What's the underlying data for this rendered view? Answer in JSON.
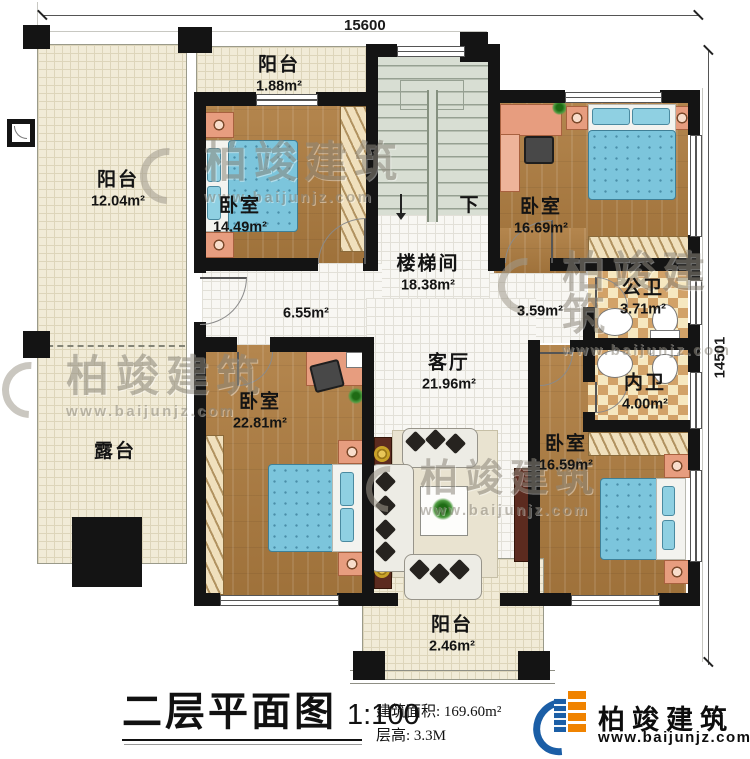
{
  "dimensions": {
    "top_width": "15600",
    "right_height": "14501"
  },
  "rooms": {
    "balcony_left": {
      "name": "阳台",
      "area": "12.04m²"
    },
    "terrace": {
      "name": "露台"
    },
    "balcony_top": {
      "name": "阳台",
      "area": "1.88m²"
    },
    "bedroom_top_left": {
      "name": "卧室",
      "area": "14.49m²"
    },
    "stairwell": {
      "name": "楼梯间",
      "area": "18.38m²",
      "direction": "下"
    },
    "bedroom_top_right": {
      "name": "卧室",
      "area": "16.69m²"
    },
    "hallway": {
      "area": "6.55m²"
    },
    "corridor": {
      "area": "3.59m²"
    },
    "living_room": {
      "name": "客厅",
      "area": "21.96m²"
    },
    "public_bath": {
      "name": "公卫",
      "area": "3.71m²"
    },
    "inner_bath": {
      "name": "内卫",
      "area": "4.00m²"
    },
    "bedroom_bottom_left": {
      "name": "卧室",
      "area": "22.81m²"
    },
    "bedroom_bottom_right": {
      "name": "卧室",
      "area": "16.59m²"
    },
    "balcony_bottom": {
      "name": "阳台",
      "area": "2.46m²"
    }
  },
  "title_block": {
    "title": "二层平面图",
    "scale": "1:100",
    "building_area_label": "建筑面积:",
    "building_area_value": "169.60m²",
    "floor_height_label": "层高:",
    "floor_height_value": "3.3M"
  },
  "logo": {
    "name": "柏竣建筑",
    "website": "www.baijunjz.com"
  },
  "watermark": {
    "name": "柏竣建筑",
    "website": "www.baijunjz.com"
  },
  "colors": {
    "brand_blue": "#1b5ea6",
    "brand_orange": "#f08300",
    "wall": "#141414"
  }
}
